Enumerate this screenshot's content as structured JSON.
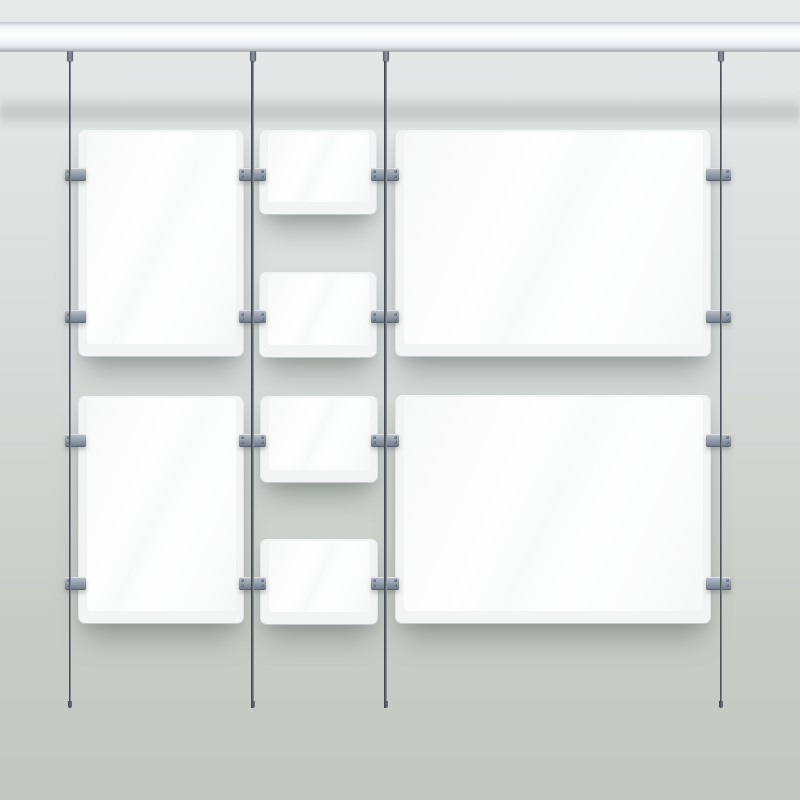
{
  "scene": {
    "description": "Rod-and-rail hanging display system with blank acrylic poster holders on a grey wall",
    "canvas": {
      "width": 800,
      "height": 800
    },
    "colors": {
      "wall_top": "#e6eae9",
      "wall_upper": "#e0e4e3",
      "wall_mid": "#d6dbd9",
      "wall_lower": "#c9cdc8",
      "wall_bottom": "#c4c7c1",
      "rail_stops": [
        "#c3c8d0",
        "#eef1f5",
        "#ffffff",
        "#f3f5f8",
        "#dde1e6",
        "#a9aeb6"
      ],
      "rod_dark": "#383d44",
      "rod_light": "#a6abb1",
      "clamp_light": "#bcc3cd",
      "clamp_dark": "#717a88",
      "panel_face": "#ffffff",
      "panel_acrylic": "#f3f5f5",
      "shadow": "rgba(96,104,99,0.45)"
    },
    "rail": {
      "top": 22,
      "height": 29
    },
    "rail_shadow": {
      "top": 95,
      "height": 33
    },
    "rods": {
      "width": 2.6,
      "top": 50,
      "bottom": 708,
      "x_centers": [
        70,
        252.5,
        385.5,
        720.8
      ],
      "fitting": {
        "width": 6,
        "height": 11
      },
      "end_cap": {
        "width": 4,
        "height": 7
      }
    },
    "panels": [
      {
        "id": "left-portrait-top",
        "x": 77.5,
        "y": 130,
        "w": 166.5,
        "h": 227
      },
      {
        "id": "left-portrait-bottom",
        "x": 77.5,
        "y": 396,
        "w": 166.5,
        "h": 227.5
      },
      {
        "id": "center-small-1",
        "x": 259,
        "y": 130,
        "w": 118,
        "h": 85
      },
      {
        "id": "center-small-2",
        "x": 259,
        "y": 271.5,
        "w": 118,
        "h": 86.5
      },
      {
        "id": "center-small-3",
        "x": 259.5,
        "y": 395.5,
        "w": 118,
        "h": 87
      },
      {
        "id": "center-small-4",
        "x": 259.5,
        "y": 538.5,
        "w": 118,
        "h": 86
      },
      {
        "id": "right-landscape-top",
        "x": 394.5,
        "y": 130,
        "w": 316.5,
        "h": 227
      },
      {
        "id": "right-landscape-bottom",
        "x": 394.5,
        "y": 395,
        "w": 316.5,
        "h": 228.5
      }
    ],
    "clamps": {
      "row_tops": [
        167.5,
        310,
        433.5,
        576.5
      ],
      "height": 13,
      "units": [
        {
          "x1": 65,
          "x2": 86,
          "bolts": "left"
        },
        {
          "x1": 238.5,
          "x2": 265.5,
          "bolts": "both"
        },
        {
          "x1": 371,
          "x2": 398.5,
          "bolts": "both"
        },
        {
          "x1": 706,
          "x2": 731,
          "bolts": "right"
        }
      ]
    }
  }
}
